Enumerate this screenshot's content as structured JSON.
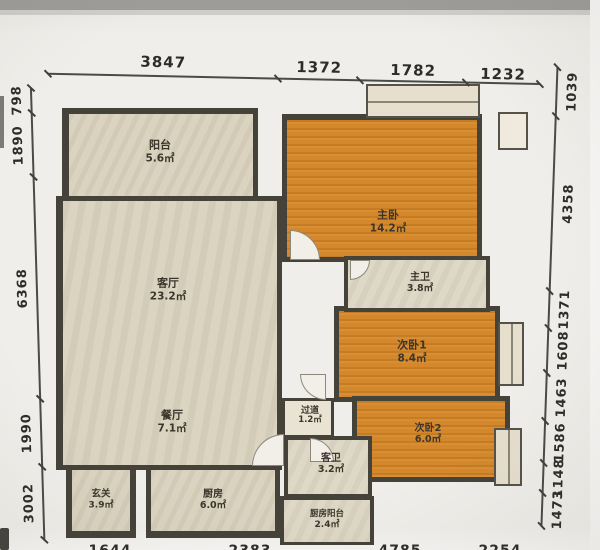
{
  "dims": {
    "top": [
      "3847",
      "1372",
      "1782",
      "1232"
    ],
    "left": [
      "798",
      "1890",
      "6368",
      "1990",
      "3002"
    ],
    "right": [
      "1039",
      "4358",
      "1371",
      "1608",
      "1463",
      "1586",
      "1148",
      "1473"
    ],
    "bottom_clipped": [
      "1644",
      "2383",
      "4785",
      "2254"
    ]
  },
  "rooms": [
    {
      "name": "阳台",
      "area": "5.6㎡"
    },
    {
      "name": "客厅",
      "area": "23.2㎡"
    },
    {
      "name": "餐厅",
      "area": "7.1㎡"
    },
    {
      "name": "玄关",
      "area": "3.9㎡"
    },
    {
      "name": "厨房",
      "area": "6.0㎡"
    },
    {
      "name": "厨房阳台",
      "area": "2.4㎡"
    },
    {
      "name": "客卫",
      "area": "3.2㎡"
    },
    {
      "name": "过道",
      "area": "1.2㎡"
    },
    {
      "name": "主卧",
      "area": "14.2㎡"
    },
    {
      "name": "主卫",
      "area": "3.8㎡"
    },
    {
      "name": "次卧1",
      "area": "8.4㎡"
    },
    {
      "name": "次卧2",
      "area": "6.0㎡"
    }
  ],
  "colors": {
    "wall": "#45423a",
    "bedroom_floor": "#d5882b",
    "living_floor": "#d8d1bd",
    "bath_floor": "#ddd6c4",
    "paper": "#f0eeea"
  }
}
